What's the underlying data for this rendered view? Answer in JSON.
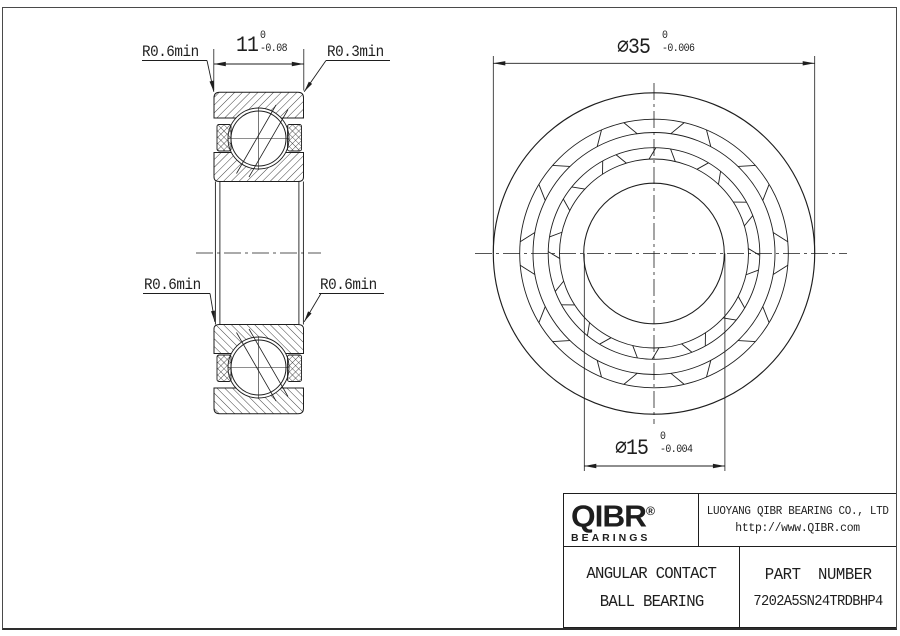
{
  "drawing": {
    "side_view": {
      "labels": {
        "r_top_left": "R0.6min",
        "r_top_right": "R0.3min",
        "r_bottom_left": "R0.6min",
        "r_bottom_right": "R0.6min"
      },
      "width_dim": {
        "value": "11",
        "tol_upper": "0",
        "tol_lower": "-0.08"
      }
    },
    "front_view": {
      "od_dim": {
        "symbol": "⌀",
        "value": "35",
        "tol_upper": "0",
        "tol_lower": "-0.006"
      },
      "bore_dim": {
        "symbol": "⌀",
        "value": "15",
        "tol_upper": "0",
        "tol_lower": "-0.004"
      }
    }
  },
  "title_block": {
    "logo": {
      "name": "QIBR",
      "registered": "®",
      "sub": "BEARINGS"
    },
    "company": {
      "line1": "LUOYANG QIBR BEARING CO., LTD",
      "line2": "http://www.QIBR.com"
    },
    "product": {
      "line1": "ANGULAR CONTACT",
      "line2": "BALL BEARING"
    },
    "part": {
      "label": "PART NUMBER",
      "number": "7202A5SN24TRDBHP4"
    }
  },
  "colors": {
    "line": "#1e1e1e",
    "background": "#ffffff",
    "page_border": "#4a4a4a"
  }
}
